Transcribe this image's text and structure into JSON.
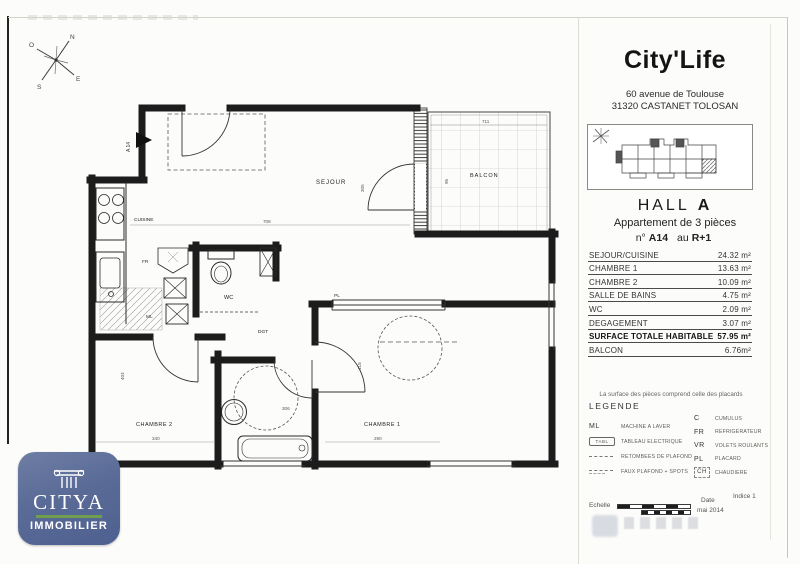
{
  "header": {
    "brand": "City'Life",
    "address_line1": "60 avenue de Toulouse",
    "address_line2": "31320 CASTANET TOLOSAN"
  },
  "unit": {
    "hall_label": "HALL",
    "hall_value": "A",
    "description": "Appartement de 3 pièces",
    "number_prefix": "n°",
    "number": "A14",
    "connector": "au",
    "floor": "R+1"
  },
  "areas": {
    "rows": [
      {
        "label": "SEJOUR/CUISINE",
        "value": "24.32 m²"
      },
      {
        "label": "CHAMBRE 1",
        "value": "13.63 m²"
      },
      {
        "label": "CHAMBRE 2",
        "value": "10.09 m²"
      },
      {
        "label": "SALLE DE BAINS",
        "value": "4.75 m²"
      },
      {
        "label": "WC",
        "value": "2.09 m²"
      },
      {
        "label": "DEGAGEMENT",
        "value": "3.07 m²"
      },
      {
        "label": "SURFACE TOTALE HABITABLE",
        "value": "57.95 m²"
      },
      {
        "label": "BALCON",
        "value": "6.76m²"
      }
    ]
  },
  "note": "La surface des pièces comprend celle des placards",
  "legend": {
    "title": "LEGENDE",
    "left": [
      {
        "symbol": "ML",
        "label": "MACHINE A LAVER"
      },
      {
        "symbol": "TABL",
        "label": "TABLEAU ELECTRIQUE"
      },
      {
        "symbol": "",
        "label": "RETOMBEES DE PLAFOND"
      },
      {
        "symbol": "",
        "label": "FAUX PLAFOND + SPOTS"
      }
    ],
    "right": [
      {
        "symbol": "C",
        "label": "CUMULUS"
      },
      {
        "symbol": "FR",
        "label": "REFRIGERATEUR"
      },
      {
        "symbol": "VR",
        "label": "VOLETS ROULANTS"
      },
      {
        "symbol": "PL",
        "label": "PLACARD"
      },
      {
        "symbol": "CH",
        "label": "CHAUDIERE"
      }
    ]
  },
  "footer": {
    "scale_label": "Echelle",
    "date_label": "Date",
    "date_value": "mai 2014",
    "revision": "Indice 1"
  },
  "compass": {
    "n": "N",
    "e": "E",
    "s": "S",
    "o": "O"
  },
  "plan": {
    "entrance": "A 14",
    "rooms": {
      "sejour": "SEJOUR",
      "cuisine": "CUISINE",
      "balcon": "BALCON",
      "wc": "WC",
      "dgt": "DGT",
      "chambre1": "CHAMBRE 1",
      "chambre2": "CHAMBRE 2"
    },
    "tags": {
      "pl": "PL",
      "fr": "FR",
      "ml": "ML"
    },
    "dims": {
      "sejour_w": "708",
      "sejour_h": "305",
      "balcon_w": "711",
      "balcon_d": "95",
      "ch2_w": "340",
      "ch2_h": "404",
      "ch1_w": "290",
      "ch1_h": "418",
      "sdb_w": "306"
    }
  },
  "logo": {
    "name": "CITYA",
    "subtitle": "IMMOBILIER",
    "badge_color": "#5d6f9a",
    "accent_color": "#6f9e4f"
  }
}
